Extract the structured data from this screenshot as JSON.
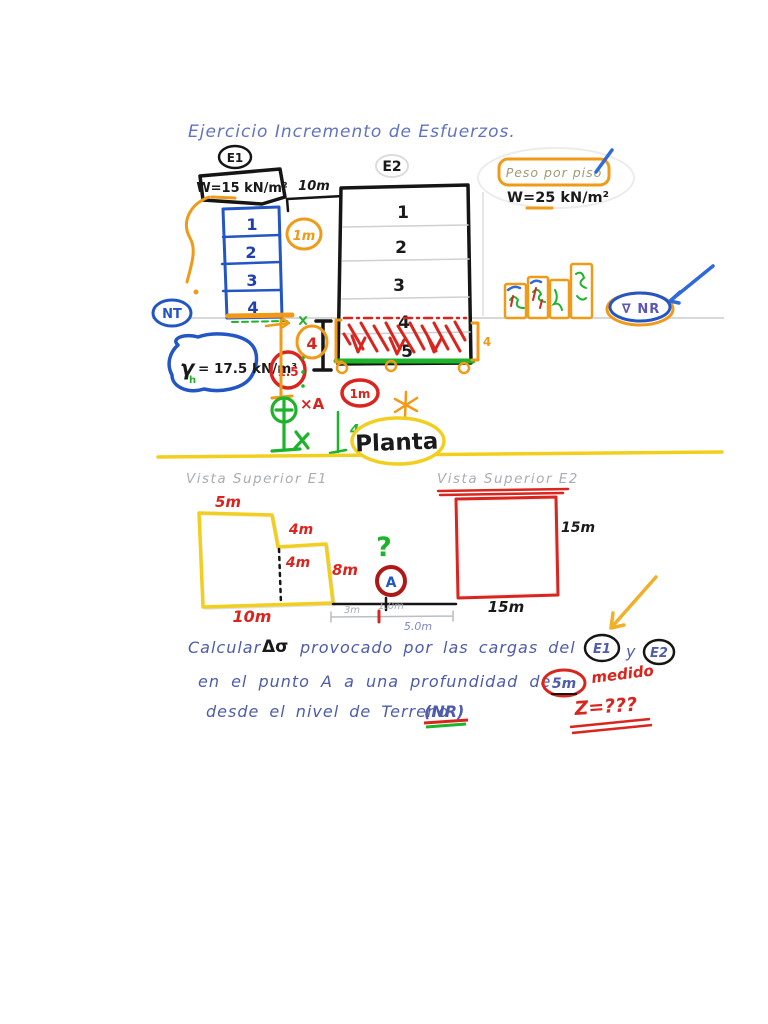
{
  "title": "Ejercicio Incremento de Esfuerzos.",
  "colors": {
    "ink_blue": "#5b6cc0",
    "ink_black": "#1a1a1a",
    "building_blue": "#2356c5",
    "orange": "#f09a18",
    "red": "#d9251d",
    "green": "#1db32a",
    "yellow": "#f2cf1f",
    "pencil_gray": "#a8adb5",
    "nr_purple": "#5b55b5"
  },
  "elevation": {
    "ground_label_left": "NT",
    "ground_label_right": "∇ NR",
    "e1": {
      "name": "E1",
      "load": "W=15 kN/m²",
      "floors": [
        "1",
        "2",
        "3",
        "4"
      ],
      "gamma_g": "γ",
      "gamma_sub": "h",
      "gamma_eq": "= 17.5 kN/m³"
    },
    "e2": {
      "name": "E2",
      "floors": [
        "1",
        "2",
        "3",
        "4",
        "5"
      ],
      "buried_depth": "4"
    },
    "annotations": {
      "dist_e1_e2": "10m",
      "circled_1m_orange": "1m",
      "circled_4": "4",
      "circled_15": "1.5",
      "circled_1m_red": "1m",
      "point_a": "×A",
      "dim_4m": "4m",
      "peso_title": "Peso por piso",
      "peso_load": "W=25 kN/m²"
    }
  },
  "plan": {
    "divider_label": "Planta",
    "e1_title": "Vista Superior E1",
    "e2_title": "Vista Superior E2",
    "e1_dims": {
      "top": "5m",
      "step": "4m",
      "inner": "4m",
      "right": "8m",
      "bottom": "10m"
    },
    "e2_dims": {
      "right": "15m",
      "bottom": "15m"
    },
    "between_dims": {
      "left": "3m",
      "mid": "1.0m",
      "total": "5.0m"
    },
    "question_mark": "?",
    "point_label": "A"
  },
  "problem": {
    "line1_a": "Calcular",
    "line1_delta": "Δσ",
    "line1_b": "provocado por las cargas del",
    "line1_e1": "E1",
    "line1_y": "y",
    "line1_e2": "E2",
    "line2_a": "en el punto A a una profundidad de",
    "line2_depth": "5m",
    "line2_red": "medido",
    "line3_a": "desde el nivel de Terreno",
    "line3_nr": "(NR)",
    "z_unknown": "Z=???"
  }
}
